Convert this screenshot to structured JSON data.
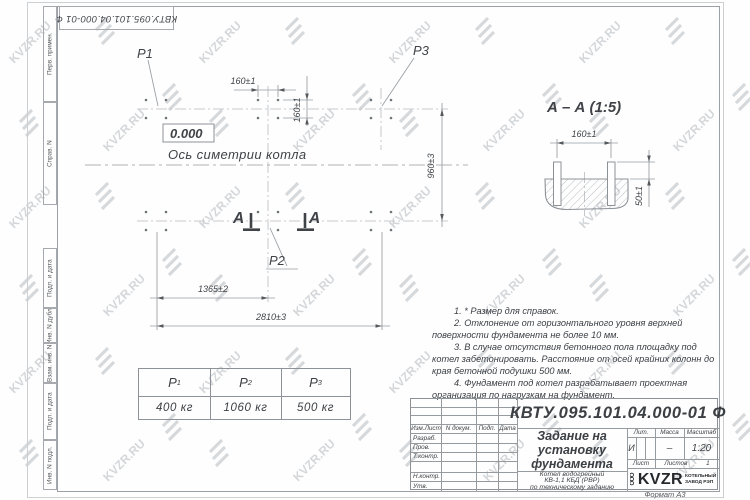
{
  "watermark": {
    "text": "KVZR.RU"
  },
  "sheet": {
    "top_stamp": "КВТУ.095.101.04.000-01 Ф",
    "margin_fields": [
      "Перв. примен.",
      "Справ. N",
      "Подп. и дата",
      "Инв. N дубл.",
      "Взам. инв. N",
      "Подп. и дата",
      "Инв. N подл."
    ]
  },
  "plan": {
    "elevation_mark": "0.000",
    "axis_label": "Ось симетрии котла",
    "section_letter": "А",
    "p_labels": [
      "P1",
      "P2",
      "P3"
    ],
    "dims": {
      "bolt_spacing_h": "160±1",
      "bolt_spacing_v": "160±1",
      "height": "960±3",
      "mid_width": "1365±2",
      "total_width": "2810±3"
    }
  },
  "section_aa": {
    "title": "А – А (1:5)",
    "dims": {
      "bolt_spacing": "160±1",
      "protrusion": "50±1"
    }
  },
  "load_table": {
    "columns": [
      {
        "name": "P",
        "sub": "1",
        "value": "400 кг"
      },
      {
        "name": "P",
        "sub": "2",
        "value": "1060 кг"
      },
      {
        "name": "P",
        "sub": "3",
        "value": "500 кг"
      }
    ]
  },
  "notes": [
    "1. * Размер для справок.",
    "2. Отклонение от горизонтального уровня верхней поверхности фундамента не более 10 мм.",
    "3. В случае отсутствия бетонного пола площадку под котел забетонировать. Расстояние от осей крайних колонн до края бетонной подушки 500 мм.",
    "4. Фундамент под котел разрабатывает проектная организация по нагрузкам на фундамент."
  ],
  "title_block": {
    "doc_number": "КВТУ.095.101.04.000-01 Ф",
    "title": "Задание на установку фундамента",
    "product_lines": [
      "Котел водогрейный",
      "КВ-1,1 КБД (РВР)",
      "по техническому заданию"
    ],
    "rev_header": [
      "Изм.Лист",
      "N докум.",
      "Подп.",
      "Дата"
    ],
    "sign_labels": [
      "Разраб.",
      "Пров.",
      "Т.контр.",
      "Н.контр.",
      "Утв."
    ],
    "lit_label": "Лит.",
    "lit_value": "И",
    "mass_label": "Масса",
    "mass_value": "–",
    "scale_label": "Масштаб",
    "scale_value": "1:20",
    "sheet_label": "Лист",
    "sheets_label": "Листов",
    "sheets_value": "1",
    "company": {
      "ooo": "ООО",
      "brand": "KVZR",
      "line1": "КОТЕЛЬНЫЙ",
      "line2": "ЗАВОД РЭП"
    },
    "format": "Формат А3"
  }
}
